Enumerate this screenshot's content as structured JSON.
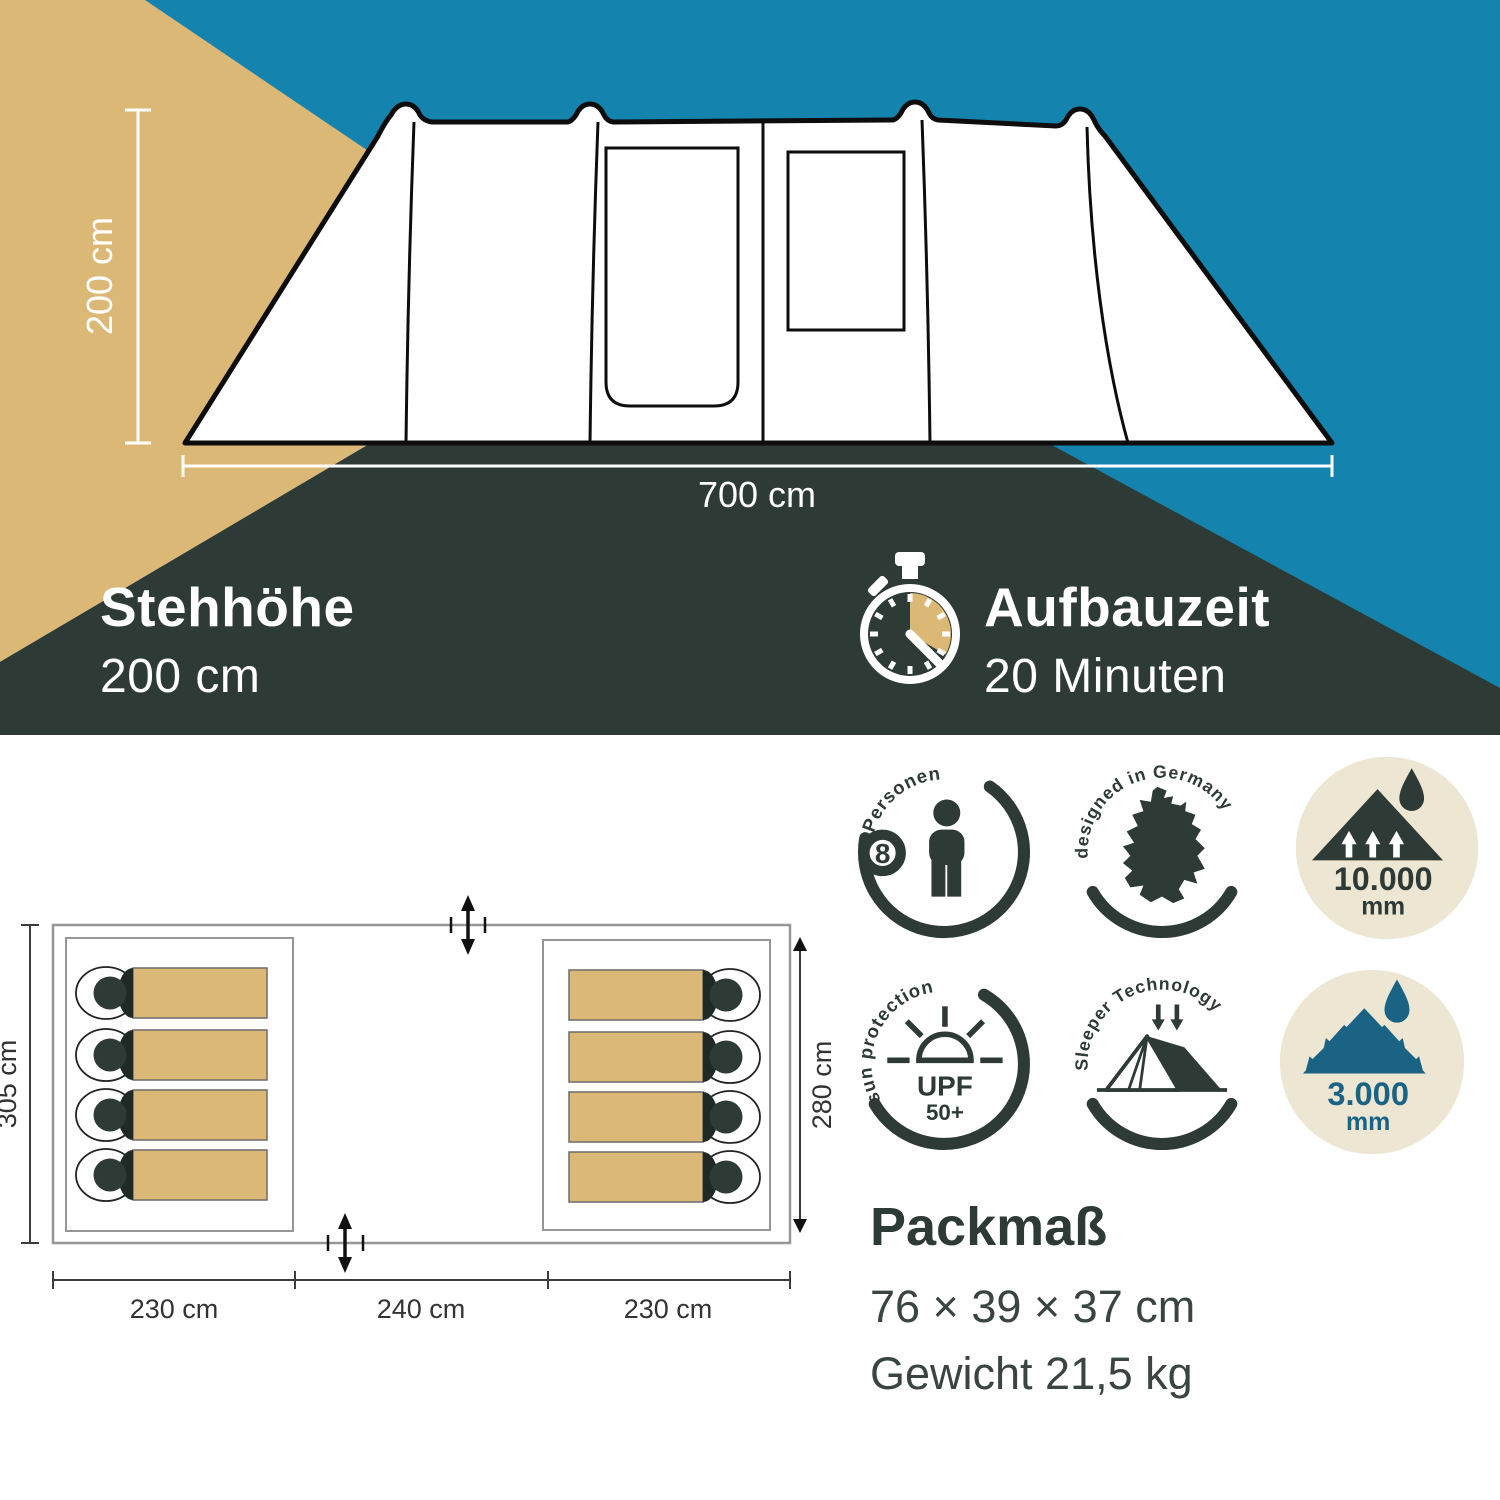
{
  "hero": {
    "height_label": "200 cm",
    "width_label": "700 cm",
    "standing_height": {
      "title": "Stehhöhe",
      "value": "200 cm"
    },
    "setup_time": {
      "title": "Aufbauzeit",
      "value": "20 Minuten"
    }
  },
  "floor_plan": {
    "depth_left": "305 cm",
    "depth_right": "280 cm",
    "width_segments": [
      "230 cm",
      "240 cm",
      "230 cm"
    ],
    "sleeping_bag_count": 8
  },
  "badges": {
    "persons": {
      "count": "8",
      "label": "Personen"
    },
    "designed": {
      "label": "designed in Germany"
    },
    "water_fly": {
      "value": "10.000",
      "unit": "mm"
    },
    "sun": {
      "label": "sun protection",
      "upf": "UPF",
      "rating": "50+"
    },
    "sleeper": {
      "label": "Sleeper Technology"
    },
    "water_floor": {
      "value": "3.000",
      "unit": "mm"
    }
  },
  "pack": {
    "title": "Packmaß",
    "dimensions": "76 × 39 × 37 cm",
    "weight": "Gewicht 21,5 kg"
  },
  "colors": {
    "tan": "#DCB877",
    "teal": "#1483AD",
    "dark": "#2E3A36",
    "cream": "#EDE6D3",
    "badge_blue": "#1A6384"
  }
}
